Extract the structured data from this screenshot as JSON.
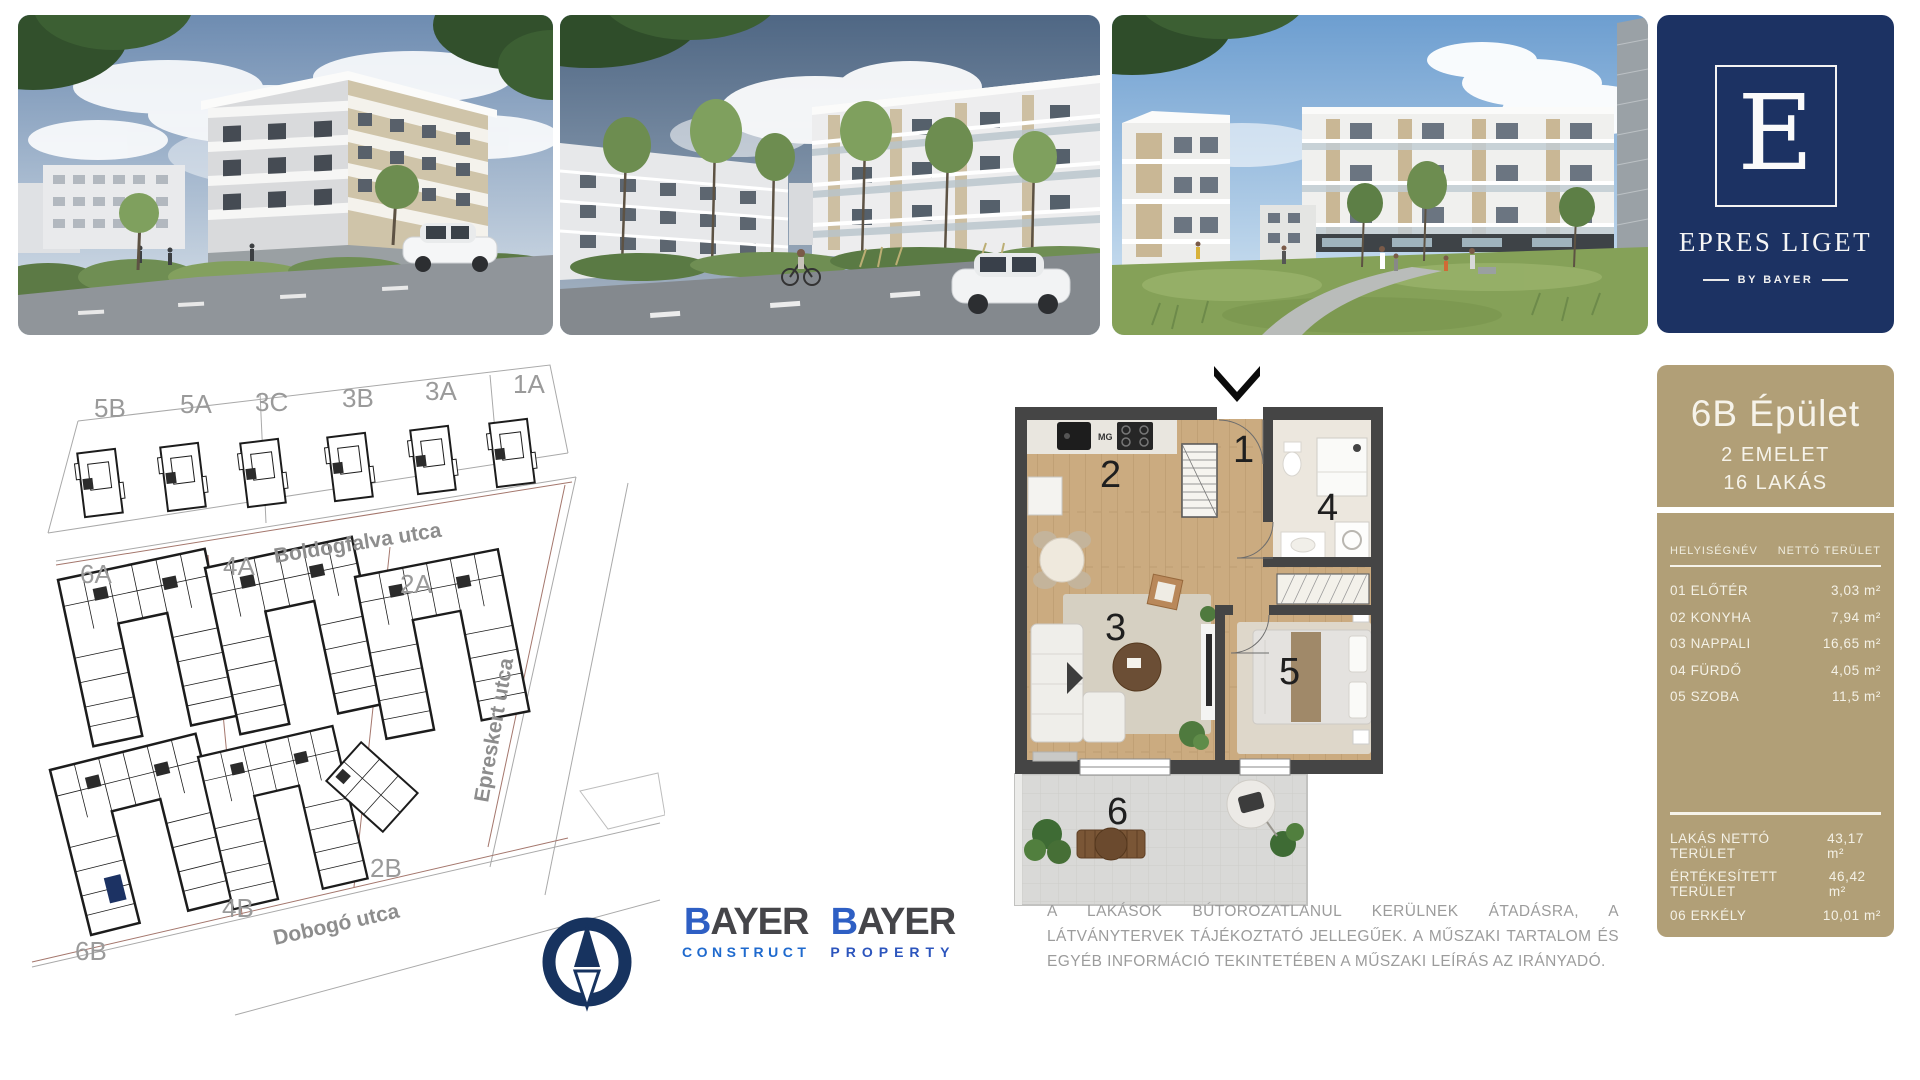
{
  "brand": {
    "monogram": "E",
    "name": "EPRES LIGET",
    "byline": "BY BAYER"
  },
  "colors": {
    "navy": "#1c3263",
    "tan": "#b19f77",
    "highlighted_unit": "#1c3263"
  },
  "site_map": {
    "street_labels": {
      "top": "Boldogfalva utca",
      "right": "Epreskert utca",
      "bottom": "Dobogó utca"
    },
    "building_labels": {
      "b5b": "5B",
      "b5a": "5A",
      "b3c": "3C",
      "b3b": "3B",
      "b3a": "3A",
      "b1a": "1A",
      "b6a": "6A",
      "b4a": "4A",
      "b2a": "2A",
      "b6b": "6B",
      "b4b": "4B",
      "b2b": "2B"
    },
    "highlighted_building": "6B"
  },
  "floor_plan": {
    "rooms": {
      "r1": "1",
      "r2": "2",
      "r3": "3",
      "r4": "4",
      "r5": "5",
      "r6": "6"
    },
    "appliance_label": "MG"
  },
  "panel": {
    "title": "6B Épület",
    "subtitle_floors": "2 EMELET",
    "subtitle_flats": "16 LAKÁS",
    "col_name": "HELYISÉGNÉV",
    "col_area": "NETTÓ TERÜLET",
    "rows": [
      {
        "name": "01 ELŐTÉR",
        "area": "3,03 m²"
      },
      {
        "name": "02 KONYHA",
        "area": "7,94 m²"
      },
      {
        "name": "03 NAPPALI",
        "area": "16,65 m²"
      },
      {
        "name": "04 FÜRDŐ",
        "area": "4,05 m²"
      },
      {
        "name": "05 SZOBA",
        "area": "11,5 m²"
      }
    ],
    "summary": [
      {
        "name": "LAKÁS NETTÓ TERÜLET",
        "area": "43,17 m²"
      },
      {
        "name": "ÉRTÉKESÍTETT TERÜLET",
        "area": "46,42 m²"
      },
      {
        "name": "06 ERKÉLY",
        "area": "10,01 m²"
      }
    ]
  },
  "logos": {
    "construct": {
      "b": "B",
      "rest": "AYER",
      "sub": "CONSTRUCT"
    },
    "property": {
      "b": "B",
      "rest": "AYER",
      "sub": "PROPERTY"
    }
  },
  "disclaimer": "A LAKÁSOK BÚTOROZATLANUL KERÜLNEK ÁTADÁSRA, A LÁTVÁNYTERVEK TÁJÉKOZTATÓ JELLEGŰEK. A MŰSZAKI TARTALOM ÉS EGYÉB INFORMÁCIÓ TEKINTETÉBEN A MŰSZAKI LEÍRÁS AZ IRÁNYADÓ."
}
